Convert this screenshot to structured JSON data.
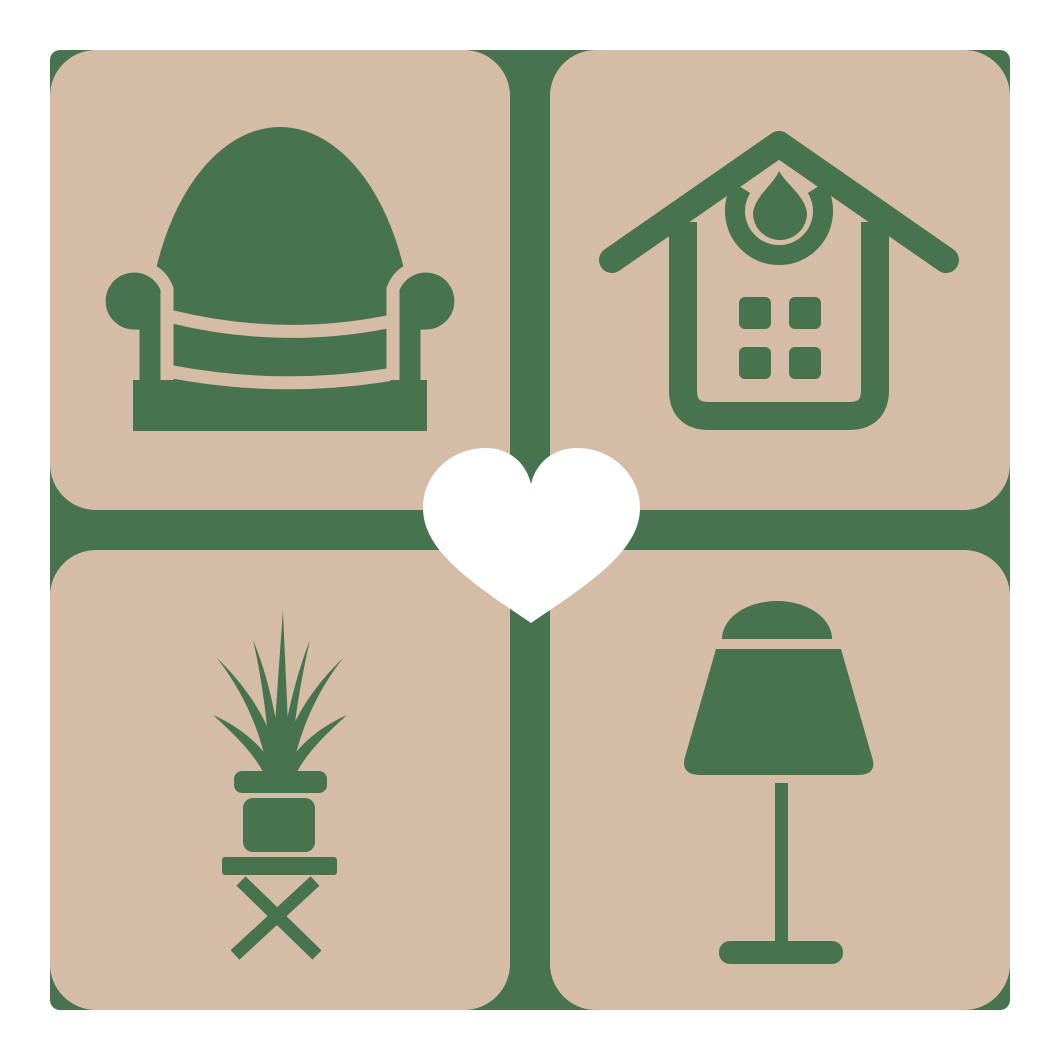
{
  "colors": {
    "background_white": "#FFFFFF",
    "grid_green": "#47734F",
    "tile_beige": "#D5BCA6",
    "icon_green": "#47734F",
    "heart_white": "#FFFFFF"
  },
  "logo": {
    "center_icon": "heart-icon",
    "tiles": [
      {
        "position": "top-left",
        "icon": "armchair-icon"
      },
      {
        "position": "top-right",
        "icon": "house-icon"
      },
      {
        "position": "bottom-left",
        "icon": "potted-plant-icon"
      },
      {
        "position": "bottom-right",
        "icon": "table-lamp-icon"
      }
    ]
  }
}
